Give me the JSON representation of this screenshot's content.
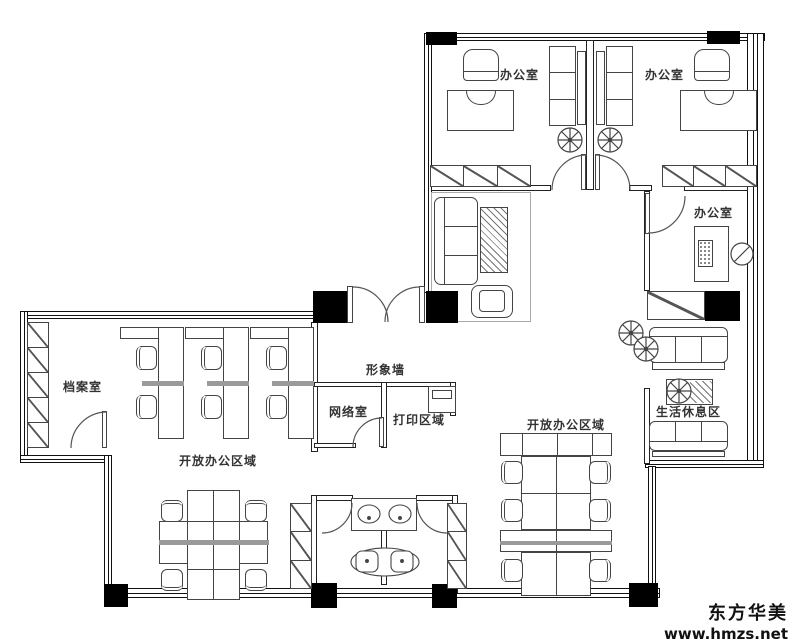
{
  "title": "office floor plan",
  "rooms": {
    "office_1": "办公室",
    "office_2": "办公室",
    "office_3": "办公室",
    "archive": "档案室",
    "feature_wall": "形象墙",
    "network": "网络室",
    "print_area": "打印区域",
    "open_office_left": "开放办公区域",
    "open_office_right": "开放办公区域",
    "rest_area": "生活休息区"
  },
  "watermark": {
    "brand": "东方华美",
    "url": "www.hmzs.net"
  },
  "colors": {
    "background": "#ffffff",
    "wall": "#111111",
    "furniture_line": "#444444",
    "partition": "#9a9a9a",
    "column": "#000000",
    "label_text": "#333333",
    "watermark_text": "#111111"
  }
}
